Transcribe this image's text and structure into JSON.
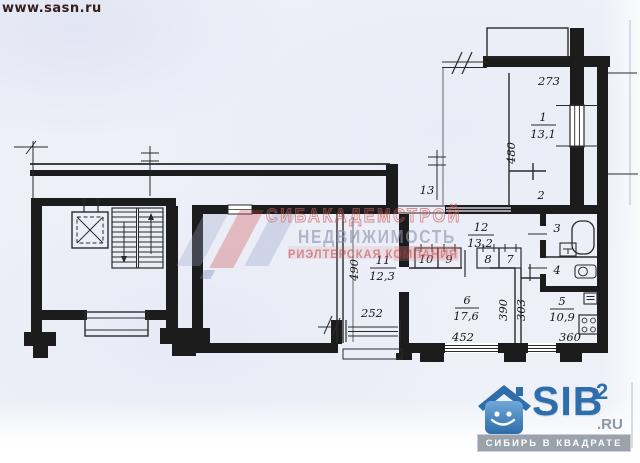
{
  "page": {
    "url": "www.sasn.ru"
  },
  "watermark": {
    "line1": "СИБАКАДЕМСТРОЙ",
    "line2": "НЕДВИЖИМОСТЬ",
    "line3": "РИЭЛТЕРСКАЯ КОМПАНИЯ"
  },
  "brand": {
    "name": "SIB",
    "sup": "2",
    "tld": ".RU",
    "tagline": "СИБИРЬ В КВАДРАТЕ"
  },
  "colors": {
    "paper": "#eef0f8",
    "ink": "#1c1c1c",
    "watermark_red": "#c94b4b",
    "watermark_blue": "#8d95b0",
    "brand_blue": "#2d6fad",
    "tagline_bar_gray": "#9aa2ab"
  },
  "plan": {
    "rooms": {
      "r1": {
        "num": "1",
        "area": "13,1"
      },
      "r2": {
        "num": "2"
      },
      "r3": {
        "num": "3"
      },
      "r4": {
        "num": "4"
      },
      "r5": {
        "num": "5",
        "area": "10,9"
      },
      "r6": {
        "num": "6",
        "area": "17,6"
      },
      "r7": {
        "num": "7"
      },
      "r8": {
        "num": "8"
      },
      "r9": {
        "num": "9"
      },
      "r10": {
        "num": "10"
      },
      "r11": {
        "num": "11",
        "area": "12,3"
      },
      "r12": {
        "num": "12",
        "area": "13,2"
      },
      "r13": {
        "num": "13"
      }
    },
    "dims": {
      "d273": "273",
      "d480": "480",
      "d490": "490",
      "d252": "252",
      "d452": "452",
      "d390": "390",
      "d303": "303",
      "d360": "360"
    }
  }
}
